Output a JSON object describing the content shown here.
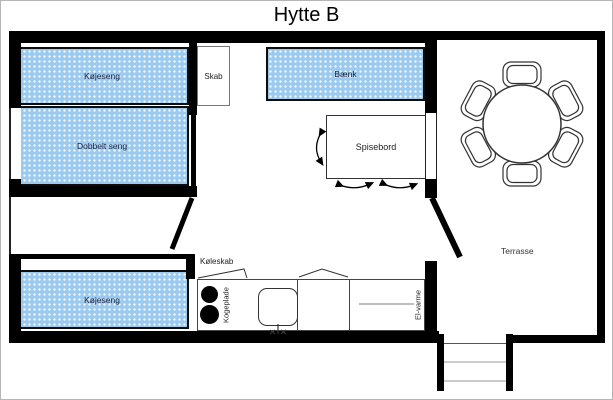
{
  "title": "Hytte B",
  "labels": {
    "bunk_bed_top": "Køjeseng",
    "double_bed": "Dobbelt seng",
    "closet": "Skab",
    "bench": "Bænk",
    "dining_table": "Spisebord",
    "bunk_bed_bottom": "Køjeseng",
    "fridge": "Køleskab",
    "hotplate": "Kogeplade",
    "electric_heater": "El-varme",
    "terrace": "Terrasse"
  },
  "colors": {
    "furniture_fill": "#9BCAEE",
    "wall": "#000000",
    "outline": "#333333",
    "label_text": "#1A1F3C"
  }
}
